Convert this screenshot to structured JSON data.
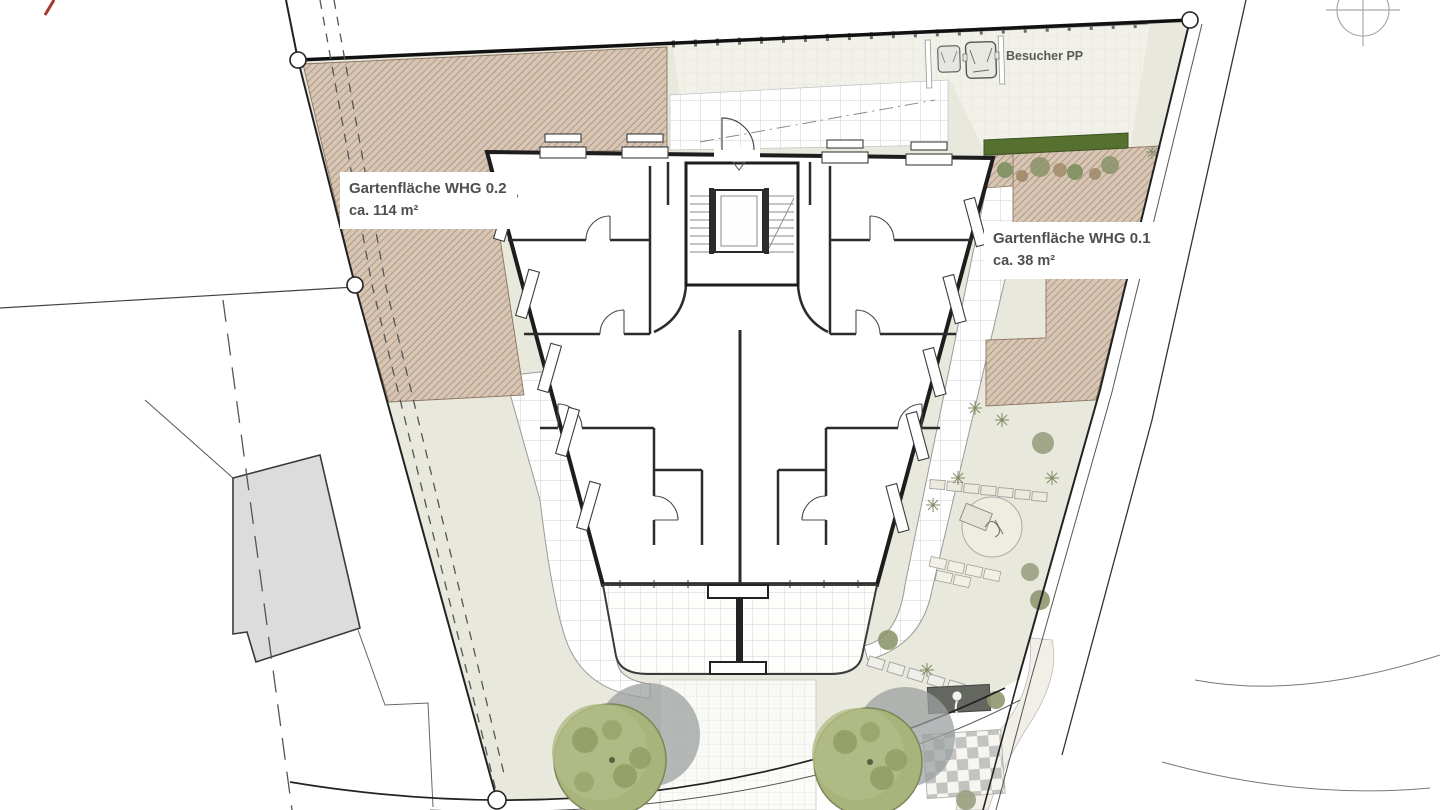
{
  "plan": {
    "title": "Lageplan Erdgeschoss",
    "labels": {
      "garden_whg02_line1": "Gartenfläche WHG 0.2",
      "garden_whg02_line2": "ca. 114 m²",
      "garden_whg01_line1": "Gartenfläche WHG 0.1",
      "garden_whg01_line2": "ca. 38 m²",
      "visitor_parking": "Besucher PP"
    },
    "colors": {
      "site_ground": "#e9e8dc",
      "garden_hatch_fill": "#d7c6b6",
      "garden_hatch_line": "#a08669",
      "hedge_green": "#55702f",
      "tree_green": "#a9b37c",
      "tree_shadow": "#9ba0a0",
      "neighbor_building": "#dcdcdc",
      "wall_dark": "#1d1d1d",
      "label_text": "#4f4f4f",
      "logo_red": "#a03a2e"
    }
  }
}
